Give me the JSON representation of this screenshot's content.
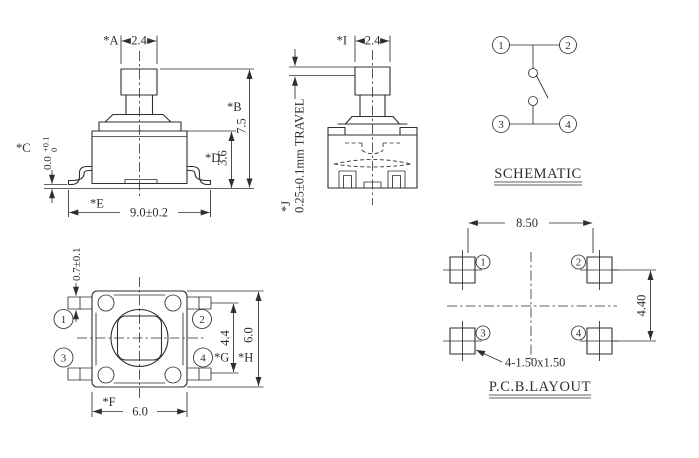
{
  "drawing": {
    "front": {
      "a_label": "*A",
      "a_value": "2.4",
      "b_label": "*B",
      "b_value": "7.5",
      "c_label": "*C",
      "c_value": "0.0",
      "c_tol_upper": "+0.1",
      "c_tol_lower": "0",
      "d_label": "*D",
      "d_value": "3.6",
      "e_label": "*E",
      "e_value": "9.0±0.2"
    },
    "side": {
      "i_label": "*I",
      "i_value": "2.4",
      "j_label": "*J",
      "j_value": "0.25±0.1mm TRAVEL"
    },
    "schematic": {
      "title": "SCHEMATIC",
      "terminals": [
        "1",
        "2",
        "3",
        "4"
      ]
    },
    "top": {
      "lead_width": "0.7±0.1",
      "f_label": "*F",
      "f_value": "6.0",
      "g_label": "*G",
      "g_value": "4.4",
      "h_label": "*H",
      "h_value": "6.0",
      "terminals": [
        "1",
        "2",
        "3",
        "4"
      ]
    },
    "pcb": {
      "title": "P.C.B.LAYOUT",
      "pitch_x": "8.50",
      "pitch_y": "4.40",
      "pad_note": "4-1.50x1.50",
      "terminals": [
        "1",
        "2",
        "3",
        "4"
      ]
    }
  },
  "colors": {
    "line": "#2e2e2e",
    "background": "#ffffff"
  }
}
